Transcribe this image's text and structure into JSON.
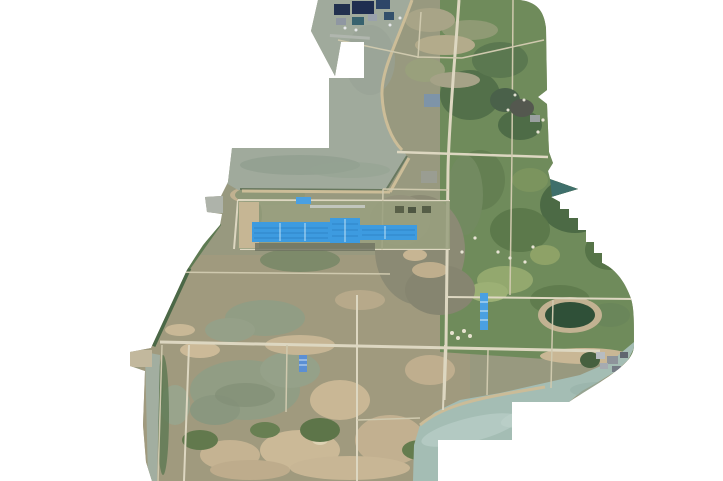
{
  "page": {
    "title": "Aerial orthomosaic survey map",
    "background_color": "#ffffff"
  },
  "map": {
    "type": "drone-orthophoto-mosaic",
    "description": "Irregularly bounded aerial photo mosaic of a coastal mixed-use area: harbor village at top, grey-green lagoon band, long blue-roofed factory at center-left, grey marsh flats in the middle, green farmland on the east half with stair-stepped mosaic edge, wetland ponds at lower-left, a dirt road grid, and bay water with stepped white cutouts at the lower-right.",
    "features": [
      {
        "id": "village",
        "label": "Harbor village with dark-roofed buildings",
        "position": "top"
      },
      {
        "id": "upper-lagoon",
        "label": "Grey-green lagoon water band",
        "position": "upper-left"
      },
      {
        "id": "factory",
        "label": "Long bright-blue roofed factory compound",
        "position": "center-left"
      },
      {
        "id": "marsh",
        "label": "Grey-brown marsh flats",
        "position": "center"
      },
      {
        "id": "farmland",
        "label": "Green farmland and scrub",
        "position": "east-half"
      },
      {
        "id": "ponds",
        "label": "Wetland ponds",
        "position": "lower-left"
      },
      {
        "id": "bay",
        "label": "Bay water with stepped mosaic cutout",
        "position": "bottom-right"
      },
      {
        "id": "blue-shed-east",
        "label": "Small blue-roofed shed",
        "position": "center-right"
      },
      {
        "id": "blue-shed-south",
        "label": "Small blue-roofed shed",
        "position": "south-center"
      },
      {
        "id": "dark-pond",
        "label": "Dark green pond with sandy rim",
        "position": "center-right"
      },
      {
        "id": "main-road",
        "label": "Main north-south road",
        "position": "center"
      },
      {
        "id": "road-grid",
        "label": "Dirt road grid",
        "position": "lower-half"
      },
      {
        "id": "shore-hamlet",
        "label": "Small grey hamlet on bay shore",
        "position": "bottom-right"
      }
    ],
    "colors": {
      "background": "#ffffff",
      "land_base": "#98997f",
      "lowland_tint": "#a39a7e",
      "farmland_green": "#6f8b5b",
      "dark_vegetation": "#52704a",
      "light_grass": "#93a86e",
      "marsh_grey": "#8b8a74",
      "sand_tan": "#c6b594",
      "light_sand": "#d8cbaa",
      "lagoon_water": "#a0aa9c",
      "bay_water": "#a4bdb4",
      "pond_water": "#919d84",
      "left_channel_water": "#a2aea0",
      "dark_pond": "#2f5038",
      "road_light": "#ddd7c1",
      "road_dirt": "#cfc9ae",
      "factory_blue": "#3d9be0",
      "factory_blue_dark": "#2f86c8",
      "shed_blue": "#4aa0e2",
      "village_roof_navy": "#22314f",
      "village_roof_teal": "#37626e",
      "teal_edge_triangle": "#3f6f6b",
      "shoreline": "#68785f",
      "edge_hedge_green": "#4b6847"
    }
  }
}
